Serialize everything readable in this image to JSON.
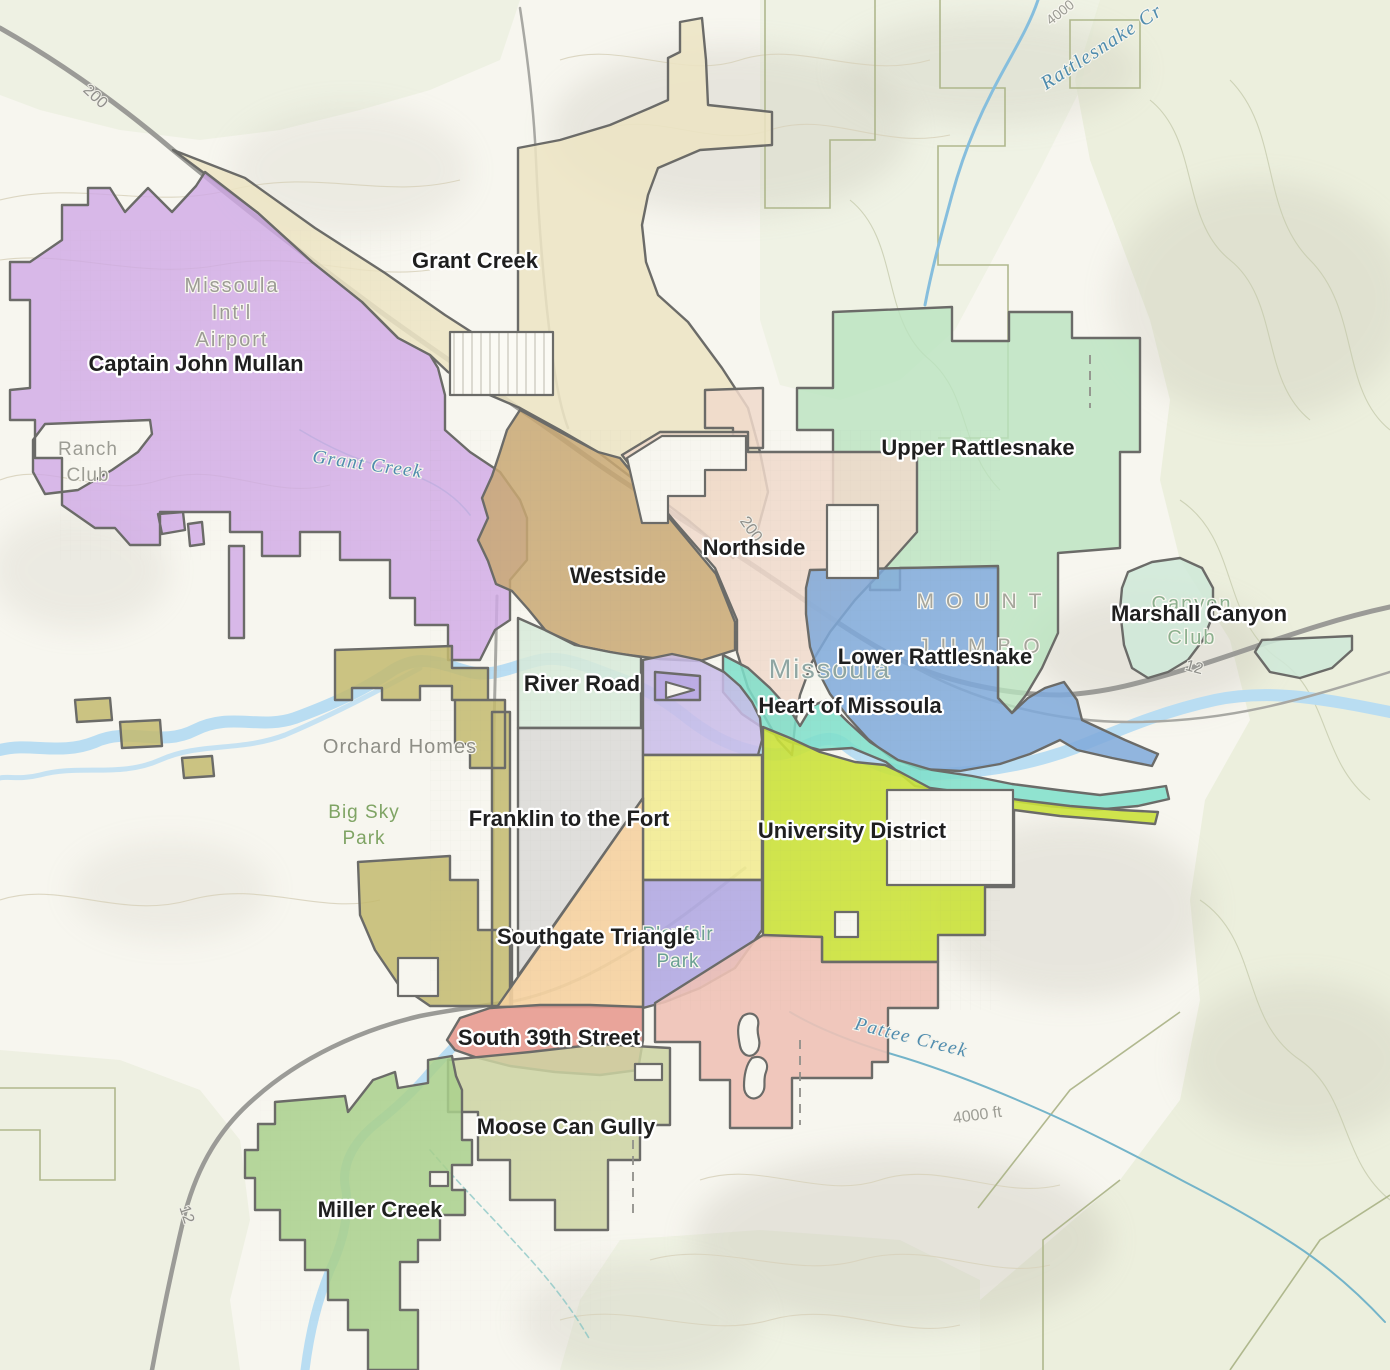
{
  "map": {
    "title": "Missoula Neighborhoods Map",
    "colors": {
      "background": "#f7f6ef",
      "region_border": "#6b6b68",
      "label_text": "#1f1f1f",
      "label_halo": "#ffffff",
      "water": "#b9ddf2",
      "creek_label": "#4f8cae",
      "road": "#9b9b97",
      "terrain_label": "#9c9c94",
      "vegetation": "#e8edd8"
    },
    "regions": [
      {
        "id": "grant-creek",
        "name": "Grant Creek",
        "color": "#ece4c3",
        "opacity": 0.85,
        "path": "M173,150 L245,178 L315,228 L385,273 L445,315 L518,362 L518,148 L560,140 L610,125 L650,108 L668,100 L668,58 L680,52 L680,22 L702,18 L706,60 L708,105 L772,112 L772,145 L700,150 L658,168 L648,195 L642,225 L646,262 L658,295 L688,322 L722,368 L748,408 L760,452 L768,492 L757,532 L733,558 L688,520 L640,484 L598,452 L560,430 L520,408 L478,390 L448,372 L430,355 L398,338 L362,302 L312,262 L258,213 Z"
      },
      {
        "id": "captain-john-mullan",
        "name": "Captain John Mullan",
        "color": "#cfa9e6",
        "opacity": 0.8,
        "path": "M205,172 L196,186 L172,212 L148,188 L125,212 L110,188 L88,188 L88,205 L62,205 L62,240 L30,262 L10,262 L10,300 L30,300 L30,388 L10,390 L10,420 L35,420 L35,458 L62,458 L62,505 L95,528 L115,528 L130,545 L160,545 L160,512 L230,512 L230,532 L262,532 L262,556 L300,556 L300,532 L340,532 L340,560 L390,560 L390,598 L415,598 L415,625 L448,625 L448,660 L480,660 L495,630 L510,620 L510,580 L527,560 L527,518 L520,500 L500,472 L470,452 L445,430 L445,395 L438,368 L430,355 L398,338 L362,302 L312,262 L258,213 Z M45,424 L150,420 L152,434 L138,452 L112,470 L78,490 L45,494 L33,472 L33,440 Z M158,514 L183,512 L185,530 L162,534 Z M188,524 L202,522 L204,544 L190,546 Z M229,546 L244,546 L244,638 L229,638 Z"
      },
      {
        "id": "upper-rattlesnake",
        "name": "Upper Rattlesnake",
        "color": "#b9e3bf",
        "opacity": 0.8,
        "path": "M833,312 L952,307 L952,341 L1009,341 L1009,312 L1072,312 L1072,338 L1140,338 L1140,452 L1120,452 L1120,548 L1058,553 L1058,633 L1042,668 L1026,695 L1012,713 L998,698 L998,568 L900,568 L900,590 L870,590 L870,568 L833,568 L833,430 L797,430 L797,388 L833,388 Z"
      },
      {
        "id": "marshall-canyon",
        "name": "Marshall Canyon",
        "color": "#cfe9d8",
        "opacity": 0.85,
        "path": "M1128,572 L1152,562 L1180,558 L1202,568 L1213,588 L1213,615 L1203,640 L1188,660 L1168,672 L1148,678 L1132,668 L1124,645 L1120,610 L1122,588 Z M1255,652 L1262,640 L1352,636 L1352,650 L1332,668 L1300,678 L1270,672 Z"
      },
      {
        "id": "northside-annex",
        "name": "Northside",
        "color": "#f0d9cb",
        "opacity": 0.85,
        "path": "M705,390 L763,388 L763,448 L733,448 L733,428 L705,428 Z"
      },
      {
        "id": "northside",
        "name": "Northside",
        "color": "#f0d9cb",
        "opacity": 0.85,
        "path": "M622,455 L660,432 L748,432 L748,452 L917,452 L917,532 L885,568 L855,600 L830,632 L812,662 L800,695 L795,725 L792,755 L778,740 L762,712 L748,688 L737,652 L737,620 L715,568 L695,545 L675,522 L655,498 L640,478 Z"
      },
      {
        "id": "westside",
        "name": "Westside",
        "color": "#c9a873",
        "opacity": 0.85,
        "path": "M520,410 L560,432 L598,452 L620,458 L638,480 L656,502 L676,526 L696,550 L716,574 L735,622 L735,650 L700,661 L660,659 L620,654 L580,646 L546,631 L528,609 L512,591 L496,584 L488,561 L478,540 L488,518 L482,498 L492,476 L500,452 L507,430 Z"
      },
      {
        "id": "lower-rattlesnake",
        "name": "Lower Rattlesnake",
        "color": "#7fa9da",
        "opacity": 0.85,
        "path": "M810,570 L998,566 L998,698 L1012,713 L1028,698 L1045,688 L1064,682 L1077,700 L1082,720 L1125,740 L1158,754 L1152,766 L1112,758 L1077,750 L1060,740 L1030,754 L1000,764 L960,771 L920,769 L890,757 L868,739 L848,717 L830,694 L818,671 L810,647 L806,614 L806,588 Z"
      },
      {
        "id": "heart-of-missoula",
        "name": "Heart of Missoula",
        "color": "#7edfca",
        "opacity": 0.85,
        "path": "M723,655 L748,668 L770,688 L790,710 L800,726 L812,706 L826,700 L848,722 L870,742 L898,760 L932,770 L972,776 L1012,784 L1058,790 L1100,795 L1140,790 L1166,786 L1169,799 L1138,806 L1095,810 L1048,806 L1000,799 L955,792 L915,786 L886,762 L852,748 L820,750 L790,742 L766,730 L742,714 L723,692 Z"
      },
      {
        "id": "river-road",
        "name": "River Road",
        "color": "#d7ead9",
        "opacity": 0.85,
        "path": "M518,618 L545,630 L575,645 L610,652 L641,657 L641,728 L518,728 Z"
      },
      {
        "id": "river-road-annex",
        "name": "River Road",
        "color": "#c3ba6e",
        "opacity": 0.85,
        "path": "M335,650 L452,646 L452,668 L488,668 L488,700 L452,700 L452,686 L420,686 L420,700 L382,700 L382,688 L352,688 L352,700 L335,700 Z M455,700 L505,700 L505,768 L470,768 L470,744 L455,744 Z M492,712 L510,712 L510,1006 L492,1006 Z M358,862 L450,856 L450,880 L478,880 L478,930 L512,930 L512,1006 L430,1006 L398,984 L375,950 L360,915 Z M75,700 L110,698 L112,720 L77,722 Z M120,722 L160,720 L162,746 L122,748 Z M182,758 L212,756 L214,776 L184,778 Z"
      },
      {
        "id": "franklin-to-the-fort",
        "name": "Franklin to the Fort",
        "color": "#d8d8d6",
        "opacity": 0.8,
        "path": "M518,728 L643,728 L643,798 L518,976 Z"
      },
      {
        "id": "district-lavender",
        "name": "",
        "color": "#c9bce9",
        "opacity": 0.85,
        "path": "M643,660 L672,654 L700,660 L724,672 L740,686 L752,702 L760,718 L762,740 L758,755 L643,755 Z"
      },
      {
        "id": "district-yellow",
        "name": "",
        "color": "#f2ec93",
        "opacity": 0.9,
        "path": "M643,755 L762,755 L762,880 L643,880 Z"
      },
      {
        "id": "district-periwinkle",
        "name": "",
        "color": "#b1aae2",
        "opacity": 0.9,
        "path": "M643,880 L762,880 L762,930 L735,968 L700,988 L665,1002 L643,1008 Z"
      },
      {
        "id": "university-district",
        "name": "University District",
        "color": "#cbe23b",
        "opacity": 0.9,
        "path": "M763,727 L790,738 L820,752 L855,762 L885,765 L900,772 L930,788 L975,794 L1020,800 L1070,806 L1120,810 L1158,812 L1155,824 L1110,820 L1060,816 L1014,810 L1014,887 L985,887 L985,935 L938,935 L938,962 L822,962 L822,937 L763,937 Z"
      },
      {
        "id": "district-pink",
        "name": "",
        "color": "#eec2b6",
        "opacity": 0.9,
        "path": "M655,1003 L763,935 L822,937 L822,962 L938,962 L938,1008 L888,1008 L888,1062 L872,1062 L872,1078 L792,1078 L792,1128 L730,1128 L730,1080 L700,1080 L700,1042 L655,1042 Z"
      },
      {
        "id": "southgate-triangle",
        "name": "Southgate Triangle",
        "color": "#f5d2a0",
        "opacity": 0.9,
        "path": "M643,798 L643,1007 L497,1007 Z"
      },
      {
        "id": "south-39th-street",
        "name": "South 39th Street",
        "color": "#e79b90",
        "opacity": 0.9,
        "path": "M447,1040 L460,1018 L490,1008 L540,1005 L590,1005 L643,1007 L643,1040 L638,1070 L600,1075 L555,1072 L510,1066 L475,1057 L455,1050 Z"
      },
      {
        "id": "moose-can-gully",
        "name": "Moose Can Gully",
        "color": "#ccd3a2",
        "opacity": 0.85,
        "path": "M448,1060 L530,1052 L600,1044 L670,1048 L670,1125 L640,1125 L640,1160 L608,1160 L608,1230 L555,1230 L555,1200 L510,1200 L510,1160 L478,1160 L478,1112 L448,1112 Z"
      },
      {
        "id": "miller-creek",
        "name": "Miller Creek",
        "color": "#a9d08c",
        "opacity": 0.85,
        "path": "M275,1102 L345,1096 L348,1112 L373,1080 L395,1072 L398,1088 L428,1083 L428,1060 L452,1056 L456,1076 L462,1090 L462,1140 L472,1140 L472,1165 L452,1165 L452,1190 L465,1190 L465,1215 L440,1215 L440,1240 L418,1240 L418,1262 L400,1262 L400,1310 L418,1310 L418,1370 L368,1370 L368,1330 L348,1330 L348,1300 L328,1300 L328,1270 L305,1270 L305,1240 L280,1240 L280,1210 L255,1210 L255,1178 L245,1178 L245,1150 L258,1150 L258,1124 L275,1124 Z"
      },
      {
        "id": "district-patch",
        "name": "",
        "color": "#b9a8e3",
        "opacity": 0.9,
        "path": "M655,672 L700,676 L700,700 L655,700 Z"
      }
    ],
    "cutouts": [
      {
        "id": "north-hills-notch",
        "path": "M627,458 L662,436 L746,436 L746,470 L705,470 L705,496 L668,496 L668,523 L642,523 Z"
      },
      {
        "id": "northside-inholding",
        "path": "M827,505 L878,505 L878,578 L827,578 Z"
      },
      {
        "id": "mount-sentinel-inholding",
        "path": "M887,790 L1013,790 L1013,885 L887,885 Z"
      },
      {
        "id": "ud-small-inholding",
        "path": "M835,912 L858,912 L858,937 L835,937 Z"
      },
      {
        "id": "annex-b-hole",
        "path": "M398,958 L438,958 L438,996 L398,996 Z"
      },
      {
        "id": "moose-hole",
        "path": "M635,1064 L662,1064 L662,1080 L635,1080 Z"
      },
      {
        "id": "miller-hole",
        "path": "M430,1172 L448,1172 L448,1186 L430,1186 Z"
      },
      {
        "id": "pink-squiggle-holes",
        "path": "M743,1016 C752,1010 760,1016 758,1026 C756,1036 762,1040 758,1050 C752,1060 742,1056 740,1046 C738,1036 736,1024 743,1016 Z M752,1058 C762,1054 770,1062 766,1072 C762,1082 768,1088 760,1096 C752,1102 744,1096 744,1086 C744,1076 746,1064 752,1058 Z"
      },
      {
        "id": "patch-triangle-hole",
        "path": "M666,682 L694,690 L666,698 Z"
      }
    ],
    "neighborhood_labels": [
      {
        "text": "Grant Creek",
        "x": 475,
        "y": 268
      },
      {
        "text": "Captain John Mullan",
        "x": 196,
        "y": 371
      },
      {
        "text": "Upper Rattlesnake",
        "x": 978,
        "y": 455
      },
      {
        "text": "Northside",
        "x": 754,
        "y": 555
      },
      {
        "text": "Westside",
        "x": 618,
        "y": 583
      },
      {
        "text": "Marshall Canyon",
        "x": 1199,
        "y": 621
      },
      {
        "text": "Lower Rattlesnake",
        "x": 935,
        "y": 664
      },
      {
        "text": "River Road",
        "x": 582,
        "y": 691
      },
      {
        "text": "Heart of Missoula",
        "x": 850,
        "y": 713
      },
      {
        "text": "Franklin to the Fort",
        "x": 569,
        "y": 826
      },
      {
        "text": "University District",
        "x": 852,
        "y": 838
      },
      {
        "text": "Southgate Triangle",
        "x": 596,
        "y": 944
      },
      {
        "text": "South 39th Street",
        "x": 549,
        "y": 1045
      },
      {
        "text": "Moose Can Gully",
        "x": 566,
        "y": 1134
      },
      {
        "text": "Miller Creek",
        "x": 380,
        "y": 1217
      }
    ],
    "place_labels": [
      {
        "id": "airport",
        "lines": [
          "Missoula",
          "Int'l",
          "Airport"
        ],
        "x": 232,
        "y": 292,
        "lineHeight": 27,
        "size": 20,
        "color": "#9c9c94",
        "spacing": 2
      },
      {
        "id": "ranch-club",
        "lines": [
          "Ranch",
          "Club"
        ],
        "x": 88,
        "y": 455,
        "lineHeight": 26,
        "size": 19,
        "color": "#9c9c94",
        "spacing": 1
      },
      {
        "id": "orchard-homes",
        "lines": [
          "Orchard Homes"
        ],
        "x": 400,
        "y": 753,
        "lineHeight": 24,
        "size": 20,
        "color": "#8e8e86",
        "spacing": 1
      },
      {
        "id": "big-sky-park",
        "lines": [
          "Big Sky",
          "Park"
        ],
        "x": 364,
        "y": 818,
        "lineHeight": 26,
        "size": 19,
        "color": "#7fa464",
        "spacing": 1
      },
      {
        "id": "mount-jumbo",
        "lines": [
          "MOUNT",
          "JUMBO"
        ],
        "x": 985,
        "y": 608,
        "lineHeight": 45,
        "size": 21,
        "color": "#a5a59b",
        "spacing": 12
      },
      {
        "id": "missoula-city",
        "lines": [
          "Missoula"
        ],
        "x": 830,
        "y": 678,
        "lineHeight": 28,
        "size": 27,
        "color": "#8fa6a3",
        "spacing": 2
      },
      {
        "id": "canyon-club",
        "lines": [
          "Canyon",
          "Club"
        ],
        "x": 1192,
        "y": 610,
        "lineHeight": 34,
        "size": 20,
        "color": "#8cb08e",
        "spacing": 2
      },
      {
        "id": "playfair-park",
        "lines": [
          "Playfair",
          "Park"
        ],
        "x": 678,
        "y": 940,
        "lineHeight": 27,
        "size": 19,
        "color": "#6ba093",
        "spacing": 1
      },
      {
        "id": "elev-4000ft",
        "lines": [
          "4000 ft"
        ],
        "x": 978,
        "y": 1120,
        "lineHeight": 20,
        "size": 16,
        "color": "#9c9c94",
        "spacing": 0,
        "rotate": -8
      },
      {
        "id": "elev-4000",
        "lines": [
          "4000"
        ],
        "x": 1063,
        "y": 16,
        "lineHeight": 16,
        "size": 14,
        "color": "#9c9c94",
        "spacing": 0,
        "rotate": -38
      }
    ],
    "water_labels": [
      {
        "id": "rattlesnake-creek",
        "text": "Rattlesnake Cr",
        "x": 1105,
        "y": 52,
        "rotate": -33,
        "size": 20
      },
      {
        "id": "grant-creek-stream",
        "text": "Grant Creek",
        "x": 367,
        "y": 470,
        "rotate": 8,
        "size": 19
      },
      {
        "id": "pattee-creek",
        "text": "Pattee Creek",
        "x": 910,
        "y": 1043,
        "rotate": 14,
        "size": 19
      }
    ],
    "road_labels": [
      {
        "text": "200",
        "x": 92,
        "y": 100,
        "rotate": 43
      },
      {
        "text": "200",
        "x": 747,
        "y": 532,
        "rotate": 55
      },
      {
        "text": "12",
        "x": 1193,
        "y": 672,
        "rotate": 15
      },
      {
        "text": "12",
        "x": 182,
        "y": 1216,
        "rotate": 72
      }
    ]
  }
}
